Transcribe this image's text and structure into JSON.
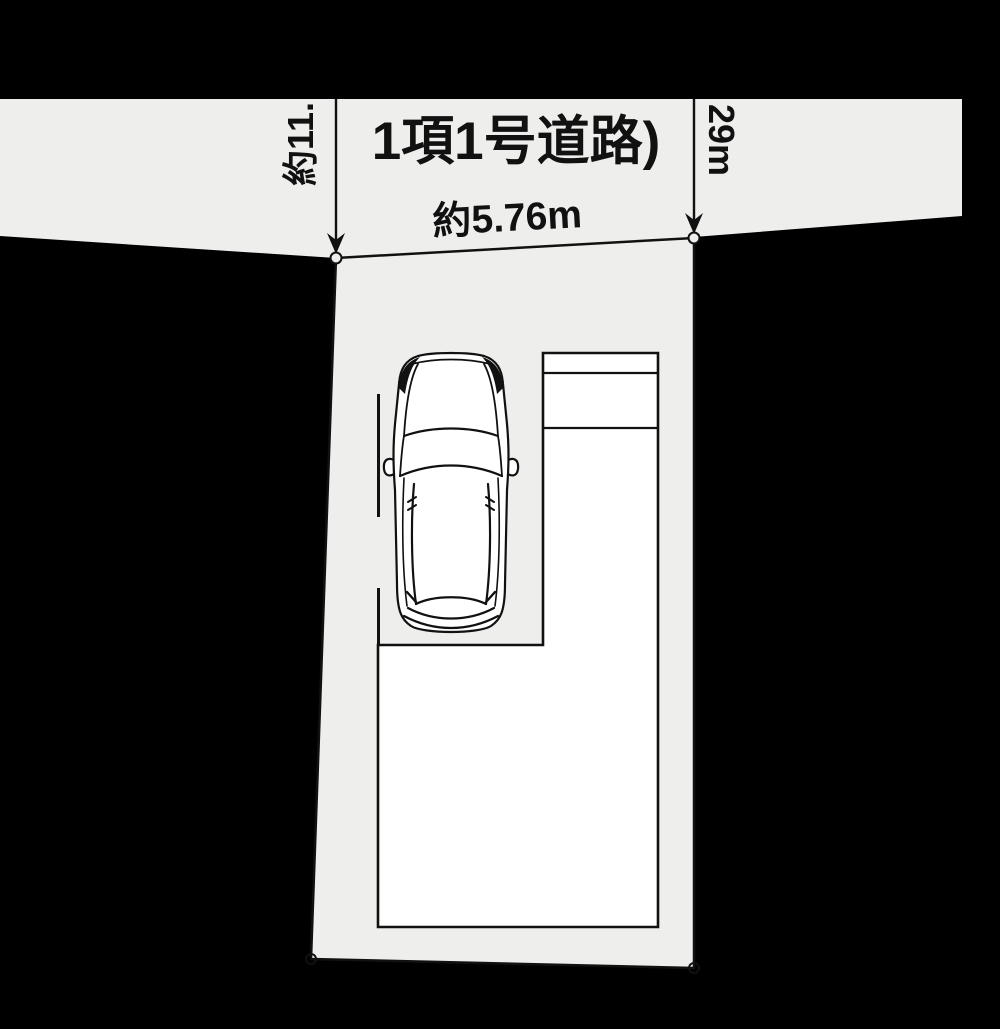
{
  "site_plan": {
    "road": {
      "name_label": "1項1号道路)",
      "frontage_label": "約5.76m",
      "left_dimension_label": "約11.",
      "right_dimension_label": "29m"
    },
    "colors": {
      "background": "#000000",
      "road_fill": "#eeeeec",
      "parcel_fill": "#eeeeec",
      "building_fill": "#ffffff",
      "outline": "#111111"
    }
  }
}
